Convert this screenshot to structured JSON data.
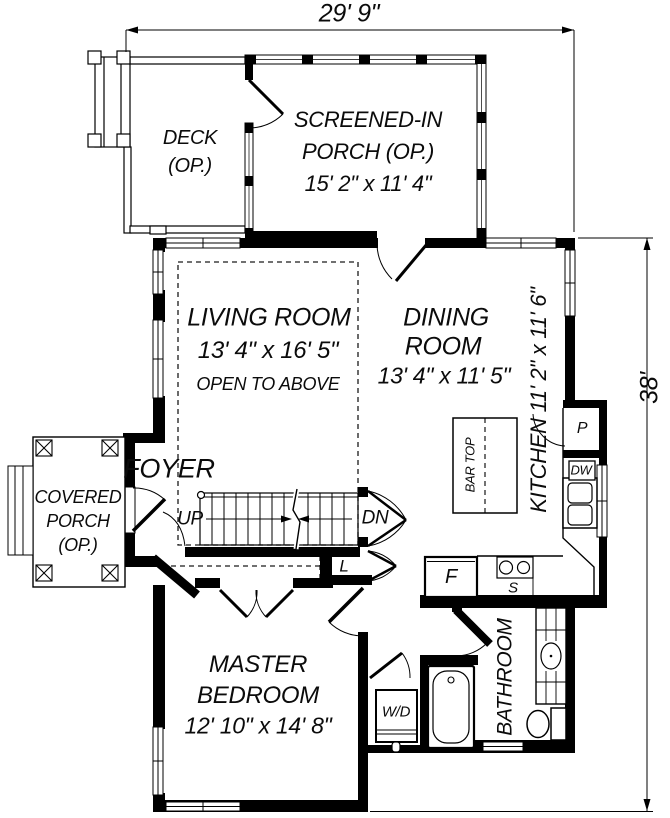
{
  "colors": {
    "ink": "#000000",
    "paper": "#ffffff"
  },
  "dimensions": {
    "width_top": "29' 9\"",
    "height_right": "38'"
  },
  "rooms": {
    "deck": {
      "name": "DECK",
      "optional": "(OP.)"
    },
    "screened_porch": {
      "name_line1": "SCREENED-IN",
      "name_line2": "PORCH (OP.)",
      "size": "15' 2\" x 11' 4\""
    },
    "living_room": {
      "name": "LIVING ROOM",
      "size": "13' 4\" x 16' 5\"",
      "note": "OPEN TO ABOVE"
    },
    "dining_room": {
      "name_line1": "DINING",
      "name_line2": "ROOM",
      "size": "13' 4\" x 11' 5\""
    },
    "kitchen": {
      "name_with_size": "KITCHEN 11' 2\" x 11' 6\""
    },
    "foyer": {
      "name": "FOYER"
    },
    "covered_porch": {
      "name_line1": "COVERED",
      "name_line2": "PORCH",
      "optional": "(OP.)"
    },
    "master_bedroom": {
      "name_line1": "MASTER",
      "name_line2": "BEDROOM",
      "size": "12' 10\" x 14' 8\""
    },
    "bathroom": {
      "name": "BATHROOM"
    }
  },
  "stairs": {
    "up": "UP",
    "down": "DN"
  },
  "fixtures": {
    "linen_closet": "L",
    "refrigerator": "F",
    "sink": "S",
    "dishwasher": "DW",
    "pantry": "P",
    "washer_dryer": "W/D",
    "bar_top": "BAR TOP"
  }
}
